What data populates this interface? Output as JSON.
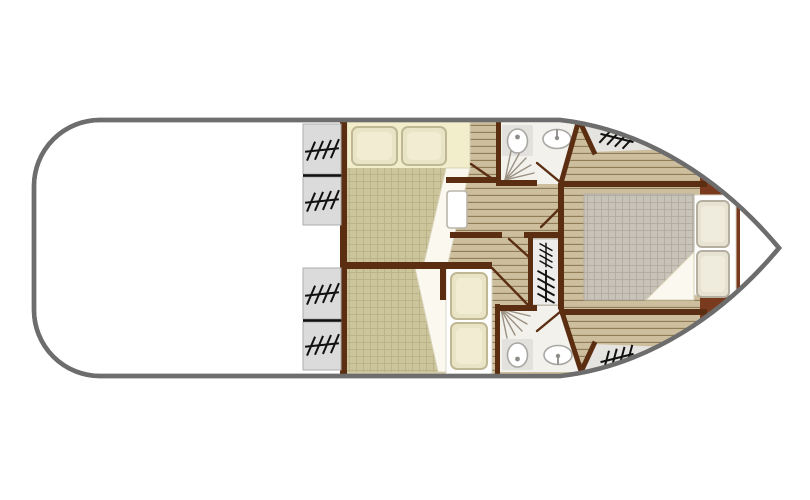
{
  "canvas": {
    "width": 810,
    "height": 500,
    "background": "#ffffff"
  },
  "palette": {
    "hull_stroke": "#6d6d6d",
    "hull_fill": "#ffffff",
    "wall": "#5b2e12",
    "floor": "#cdbf9e",
    "floor_line": "#8d7a55",
    "spread_khaki": "#ccc59c",
    "spread_khaki_line": "#b9b187",
    "spread_gray": "#c8c3b8",
    "spread_gray_line": "#b2aca0",
    "bed_cream": "#f2edca",
    "pillow": "#e9e4c5",
    "pillow_border": "#c0b894",
    "pillow_in": "#f1ecd2",
    "master_pillow": "#e7e2d2",
    "master_pillow_border": "#b4afa0",
    "master_pillow_in": "#efebdd",
    "sheet_white": "#ffffff",
    "fold": "#fbf9ef",
    "fold_line": "#d8d2b9",
    "bathroom": "#f3f1ec",
    "fixture_pad": "#e3e1dd",
    "fixture_stroke": "#a9a7a3",
    "fixture_detail": "#8f8d89",
    "band_gray": "#e6e4e0",
    "window_gray": "#dbdbdb",
    "window_border": "#adadad",
    "hatch_black": "#111111",
    "stairs_bg": "#edecea",
    "headboard": "#7a3a1e",
    "shower": "#9a9183",
    "door_line": "#5b2e12"
  },
  "plan": {
    "type": "boat-floor-plan",
    "areas": [
      {
        "name": "aft-deck",
        "features": []
      },
      {
        "name": "port-cabin-forward",
        "features": [
          "double-bed",
          "two-pillows",
          "cabin-door"
        ]
      },
      {
        "name": "port-cabin-aft",
        "features": [
          "double-bed",
          "two-pillows"
        ]
      },
      {
        "name": "bathroom-forward",
        "features": [
          "toilet",
          "sink",
          "shower"
        ]
      },
      {
        "name": "bathroom-aft",
        "features": [
          "toilet",
          "sink",
          "shower"
        ]
      },
      {
        "name": "companionway-stairs",
        "features": [
          "steps"
        ]
      },
      {
        "name": "bow-master-cabin",
        "features": [
          "double-bed",
          "two-pillows",
          "headboard"
        ]
      }
    ],
    "window_count": 8
  },
  "icons": [
    "window-hatch-icon",
    "stairs-icon",
    "toilet-icon",
    "sink-icon",
    "shower-icon",
    "door-swing-icon"
  ]
}
